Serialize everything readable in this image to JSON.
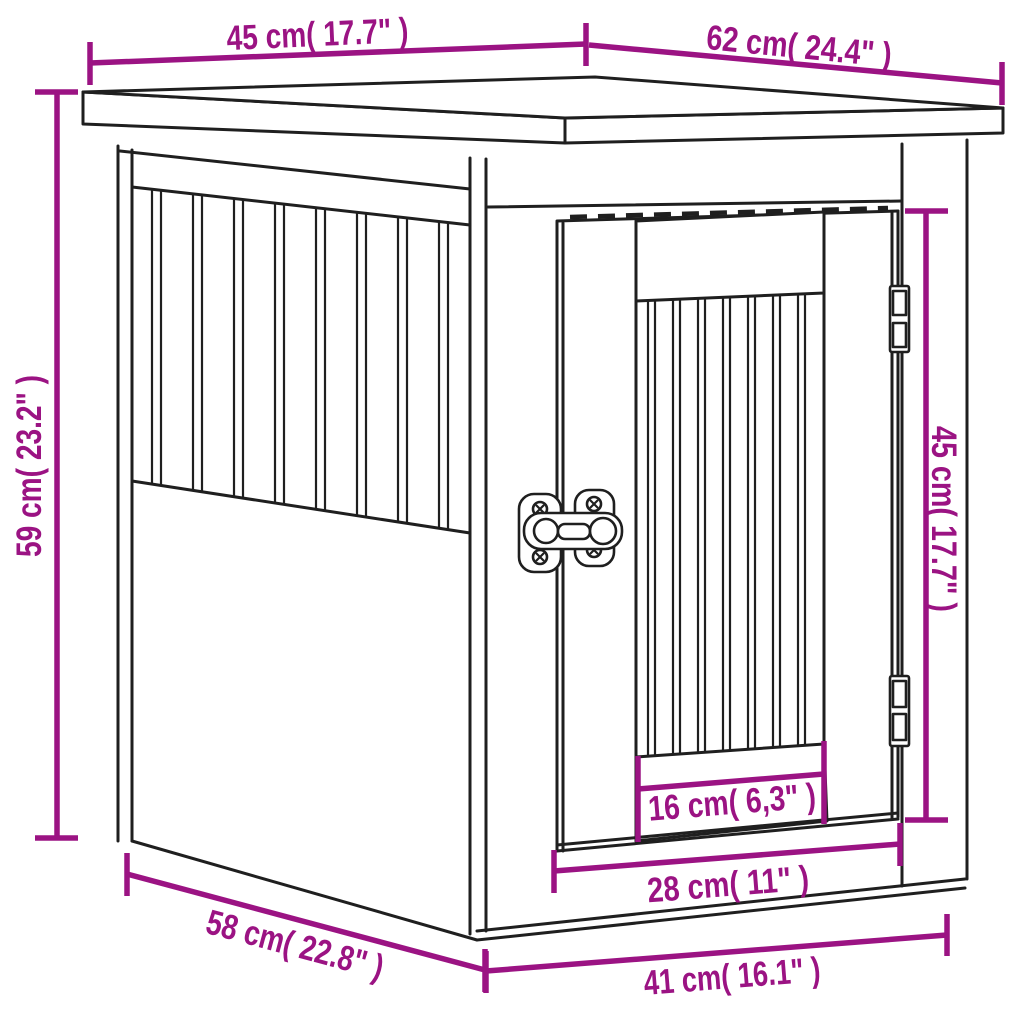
{
  "colors": {
    "dimension_accent": "#9b1383",
    "line": "#1f1f1f",
    "page_background": "#ffffff"
  },
  "diagram": {
    "type": "product-dimension-diagram",
    "subject": "dog-crate-end-table-with-barred-door",
    "dimensions": {
      "top_depth": {
        "label": "45 cm( 17.7\" )",
        "cm": 45,
        "inch": "17.7"
      },
      "top_width": {
        "label": "62 cm( 24.4\" )",
        "cm": 62,
        "inch": "24.4"
      },
      "overall_height": {
        "label": "59 cm( 23.2\" )",
        "cm": 59,
        "inch": "23.2"
      },
      "door_height": {
        "label": "45 cm( 17.7\" )",
        "cm": 45,
        "inch": "17.7"
      },
      "bar_opening_width": {
        "label": "16 cm( 6,3\" )",
        "cm": 16,
        "inch": "6,3"
      },
      "door_width": {
        "label": "28 cm( 11\" )",
        "cm": 28,
        "inch": "11"
      },
      "base_depth": {
        "label": "58 cm( 22.8\" )",
        "cm": 58,
        "inch": "22.8"
      },
      "front_width": {
        "label": "41 cm( 16.1\" )",
        "cm": 41,
        "inch": "16.1"
      }
    }
  }
}
